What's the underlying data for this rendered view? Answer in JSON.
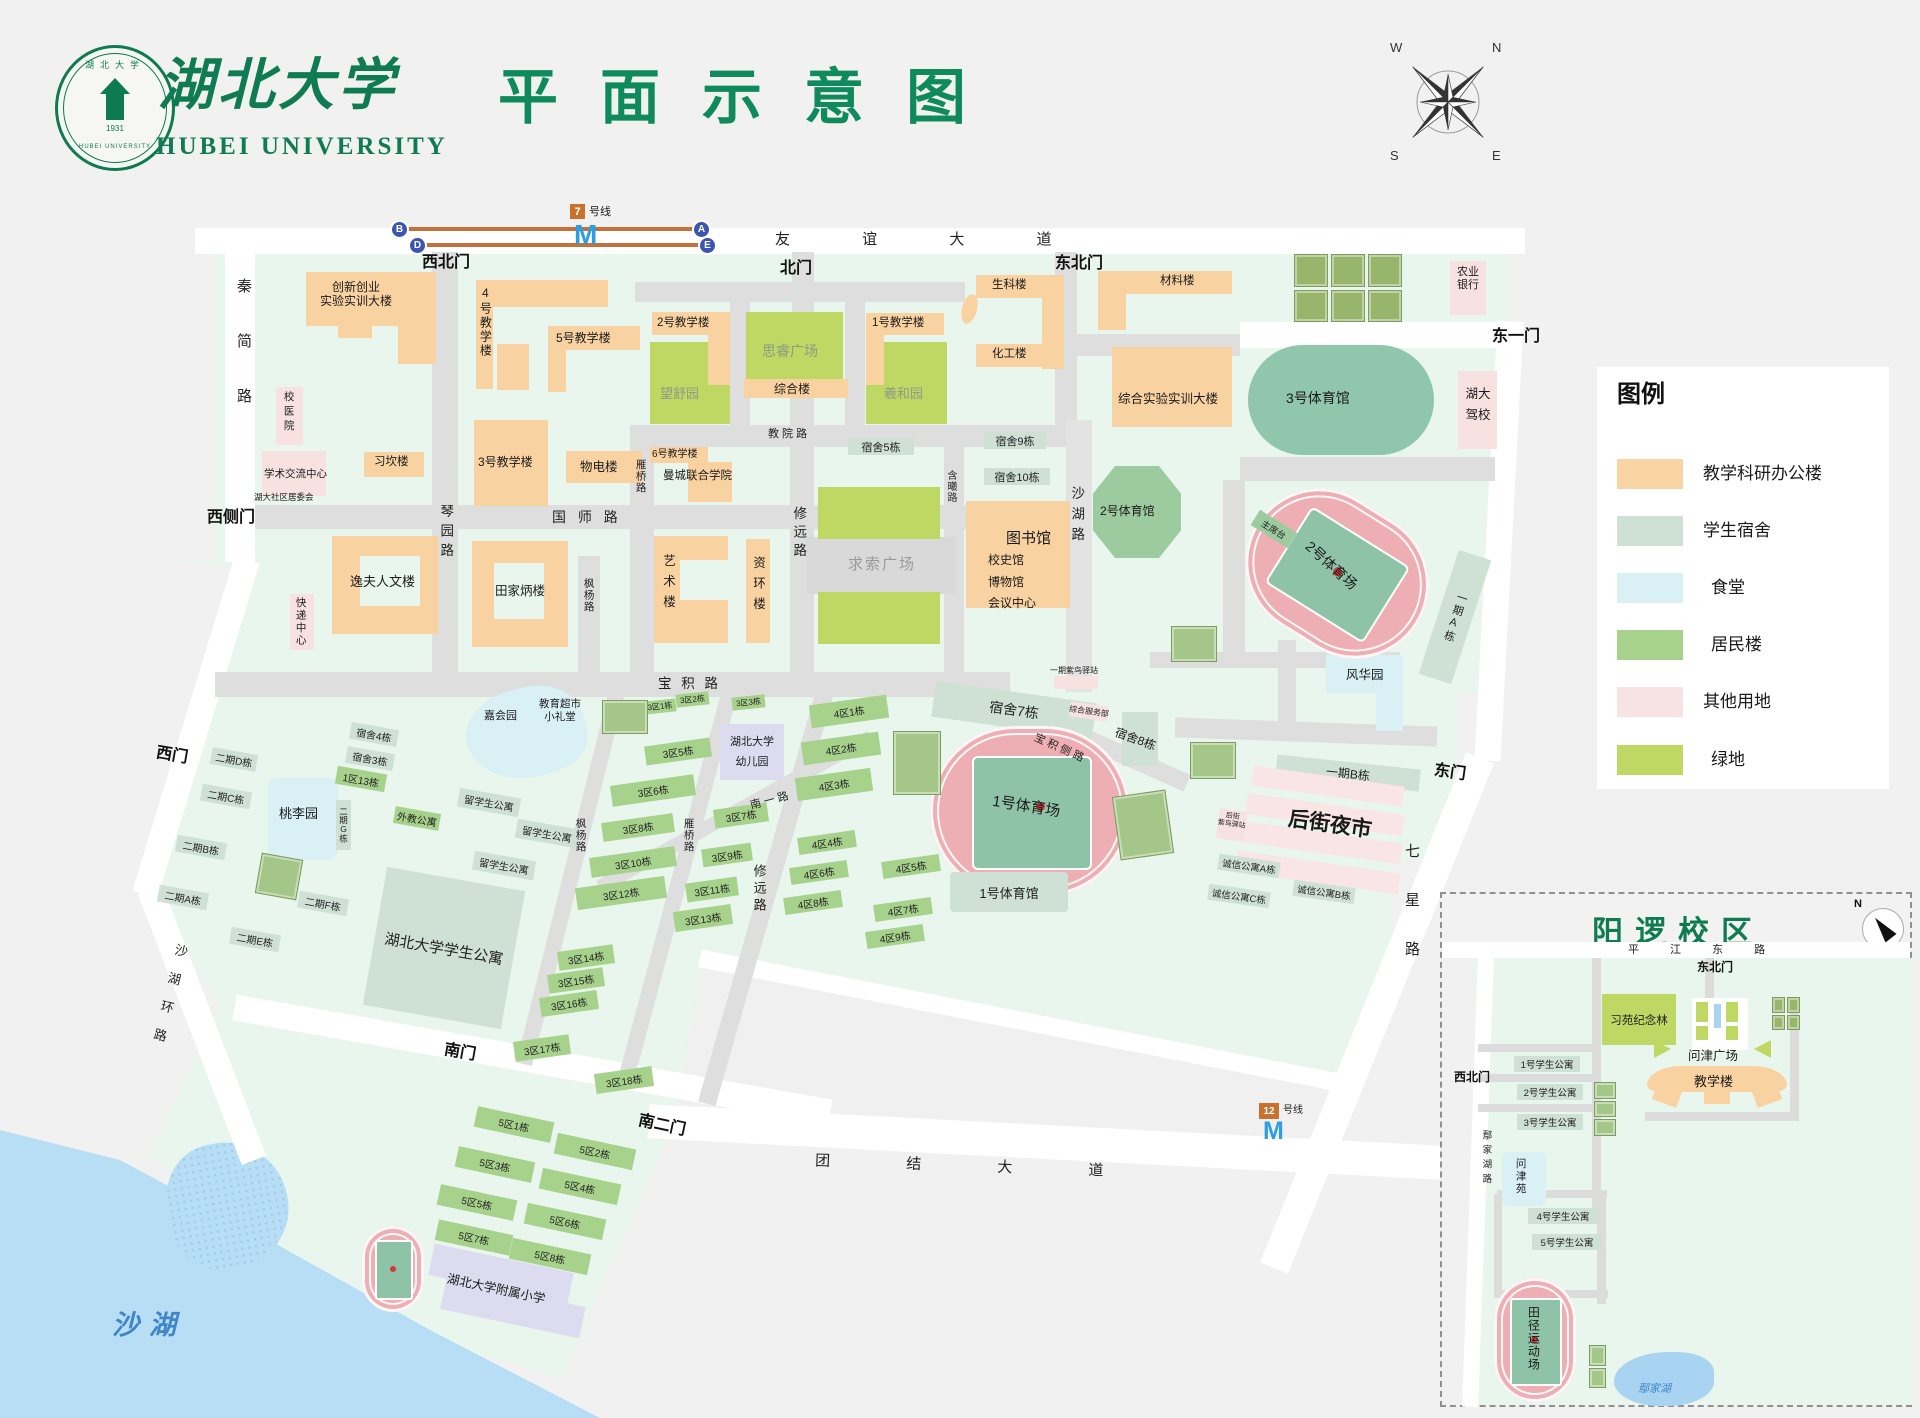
{
  "header": {
    "calligraphy": "湖北大学",
    "en": "HUBEI UNIVERSITY",
    "title": "平面示意图",
    "seal_year": "1931",
    "seal_top": "湖北大学",
    "seal_bottom": "HUBEI UNIVERSITY"
  },
  "compass": {
    "n": "N",
    "w": "W",
    "s": "S",
    "e": "E"
  },
  "legend": {
    "title": "图例",
    "items": [
      {
        "label": "教学科研办公楼",
        "color": "#FAD5A4"
      },
      {
        "label": "学生宿舍",
        "color": "#CFE0D5"
      },
      {
        "label": "食堂",
        "color": "#D9F0F5"
      },
      {
        "label": "居民楼",
        "color": "#A7D28C"
      },
      {
        "label": "其他用地",
        "color": "#F7E3E3"
      },
      {
        "label": "绿地",
        "color": "#BFD763"
      }
    ]
  },
  "metro": {
    "l7": "7",
    "l12": "12",
    "suffix": "号线",
    "m": "M",
    "a": "A",
    "b": "B",
    "d": "D",
    "e": "E"
  },
  "gates": {
    "xibei": "西北门",
    "bei": "北门",
    "dongbei": "东北门",
    "dongyi": "东一门",
    "xice": "西侧门",
    "xi": "西门",
    "nan": "南门",
    "naner": "南二门",
    "dong": "东门"
  },
  "roads": {
    "youyi": "友 谊 大 道",
    "qinjian": "秦简路",
    "qinyuan": "琴园路",
    "guoshi": "国 师 路",
    "jiaoyuan": "教 院 路",
    "yanqiao": "雁桥路",
    "fengyang": "枫杨路",
    "xiuyuan": "修远路",
    "hanxi": "含曦路",
    "shahu": "沙湖路",
    "baoji": "宝 积 路",
    "baojice": "宝 积 侧 路",
    "nanyi": "南 一 路",
    "qixing": "七星路",
    "tuanjie": "团 结 大 道",
    "shahuhuan": "沙湖环路"
  },
  "water": {
    "shahu": "沙湖",
    "yanjiahu": "鄢家湖"
  },
  "b": {
    "cx1": "创新创业",
    "cx2": "实验实训大楼",
    "t4": "4号教学楼",
    "t5": "5号教学楼",
    "t2": "2号教学楼",
    "t1": "1号教学楼",
    "t3": "3号教学楼",
    "t6": "6号教学楼",
    "zhl": "综合楼",
    "shengke": "生科楼",
    "huagong": "化工楼",
    "cailiao": "材料楼",
    "zsys": "综合实验实训大楼",
    "xikan": "习坎楼",
    "wudian": "物电楼",
    "mancheng": "曼城联合学院",
    "yifu": "逸夫人文楼",
    "tjb": "田家炳楼",
    "yishu": "艺术楼",
    "zihuan": "资环楼",
    "tsg": "图书馆",
    "xsg": "校史馆",
    "bwg": "博物馆",
    "hyzx": "会议中心",
    "xyy": "校医院",
    "xsjl": "学术交流中心",
    "shequ": "湖大社区居委会",
    "kuaidi": "快递中心",
    "ny1": "农业",
    "ny2": "银行",
    "jx1": "湖大",
    "jx2": "驾校",
    "gym3": "3号体育馆",
    "gym2": "2号体育馆",
    "gym1": "1号体育馆",
    "st2": "2号体育场",
    "st1": "1号体育场",
    "zxt": "主席台",
    "fenghua": "风华园",
    "taoli": "桃李园",
    "jiahui": "嘉会园",
    "wangshu": "望舒园",
    "sirui": "思睿广场",
    "xihe": "羲和园",
    "qiusuo": "求索广场",
    "su5": "宿舍5栋",
    "su9": "宿舍9栋",
    "su10": "宿舍10栋",
    "su7": "宿舍7栋",
    "su8": "宿舍8栋",
    "su4": "宿舍4栋",
    "su3": "宿舍3栋",
    "yqA": "一期A栋",
    "yqB": "一期B栋",
    "yqzn": "一期紫鸟驿站",
    "zhfwb": "综合服务部",
    "houjie": "后街夜市",
    "hjzn1": "后街",
    "hjzn2": "紫鸟驿站",
    "cxA": "诚信公寓A栋",
    "cxB": "诚信公寓B栋",
    "cxC": "诚信公寓C栋",
    "eqA": "二期A栋",
    "eqB": "二期B栋",
    "eqC": "二期C栋",
    "eqD": "二期D栋",
    "eqE": "二期E栋",
    "eqF": "二期F栋",
    "eqG": "二期G栋",
    "q113": "1区13栋",
    "waijiao": "外教公寓",
    "lxs": "留学生公寓",
    "hbgy": "湖北大学学生公寓",
    "jysc": "教育超市",
    "xlt": "小礼堂",
    "yey1": "湖北大学",
    "yey2": "幼儿园",
    "fuxiao": "湖北大学附属小学",
    "q3": [
      "3区1栋",
      "3区2栋",
      "3区3栋",
      "3区5栋",
      "3区6栋",
      "3区7栋",
      "3区8栋",
      "3区9栋",
      "3区10栋",
      "3区11栋",
      "3区12栋",
      "3区13栋",
      "3区14栋",
      "3区15栋",
      "3区16栋",
      "3区17栋",
      "3区18栋"
    ],
    "q4": [
      "4区1栋",
      "4区2栋",
      "4区3栋",
      "4区4栋",
      "4区5栋",
      "4区6栋",
      "4区7栋",
      "4区8栋",
      "4区9栋"
    ],
    "q5": [
      "5区1栋",
      "5区2栋",
      "5区3栋",
      "5区4栋",
      "5区5栋",
      "5区6栋",
      "5区7栋",
      "5区8栋"
    ]
  },
  "inset": {
    "title": "阳逻校区",
    "n": "N",
    "road_top": "平 江 东 路",
    "gate_ne": "东北门",
    "gate_nw": "西北门",
    "road_left": "鄢家湖路",
    "xiyuan": "习苑纪念林",
    "plaza": "问津广场",
    "jxl": "教学楼",
    "gy1": "1号学生公寓",
    "gy2": "2号学生公寓",
    "gy3": "3号学生公寓",
    "gy4": "4号学生公寓",
    "gy5": "5号学生公寓",
    "wjy": "问津苑",
    "track": "田径运动场",
    "lake": "鄢家湖"
  }
}
